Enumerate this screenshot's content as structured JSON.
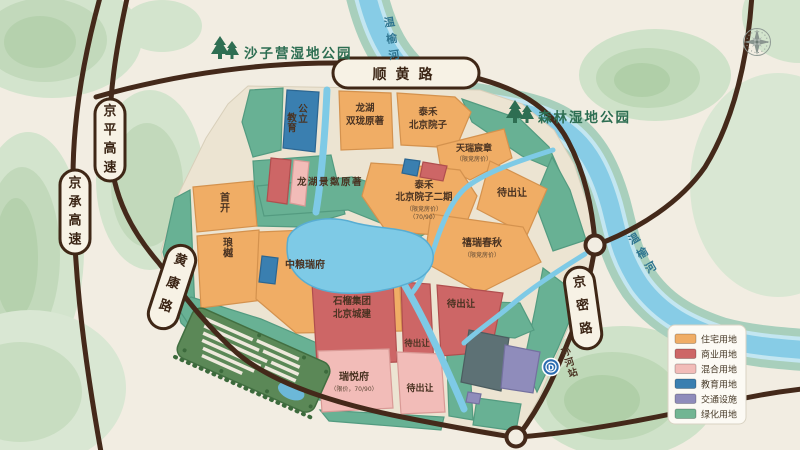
{
  "parks": {
    "shaziying": "沙子营湿地公园",
    "senlin": "森林湿地公园"
  },
  "rivers": {
    "wenyu_north": "温榆河",
    "wenyu_east": "温榆河"
  },
  "roads": {
    "shunhuang": "顺黄路",
    "jingping": "京平高速",
    "jingcheng": "京承高速",
    "huangkang": "黄康路",
    "jingmi": "京密路"
  },
  "station": {
    "name": "孙河站",
    "logo": "D"
  },
  "parcels": {
    "public_education": {
      "col1": "公立",
      "col2": "教育"
    },
    "longhu_shuanglong": {
      "line1": "龙湖",
      "line2": "双珑原著"
    },
    "taihe_yuanzi": {
      "line1": "泰禾",
      "line2": "北京院子"
    },
    "tianrui": {
      "name": "天瑞宸章",
      "note": "（限竞房价）"
    },
    "longhu_jinglin": {
      "name": "龙湖景粼原著"
    },
    "taihe_yuanzi2": {
      "line1": "泰禾",
      "line2": "北京院子二期",
      "note1": "（限竞房价）",
      "note2": "（70/90）"
    },
    "daichurang_ne": {
      "name": "待出让"
    },
    "xirui": {
      "name": "禧瑞春秋",
      "note": "（限竞房价）"
    },
    "shoukai": {
      "name": "首开"
    },
    "langyue": {
      "name": "琅樾"
    },
    "zhongliang": {
      "name": "中粮瑞府"
    },
    "shiliu": {
      "line1": "石榴集团",
      "line2": "北京城建"
    },
    "daichurang_mid": {
      "name": "待出让"
    },
    "daichurang_e": {
      "name": "待出让"
    },
    "ruiyue": {
      "name": "瑞悦府",
      "note": "（限价，70/90）"
    },
    "daichurang_s": {
      "name": "待出让"
    }
  },
  "legend": {
    "items": [
      {
        "label": "住宅用地",
        "color": "#f0ad65"
      },
      {
        "label": "商业用地",
        "color": "#cd6666"
      },
      {
        "label": "混合用地",
        "color": "#f2bcb8"
      },
      {
        "label": "教育用地",
        "color": "#3a7fb0"
      },
      {
        "label": "交通设施",
        "color": "#8f8cbb"
      },
      {
        "label": "绿化用地",
        "color": "#72b593"
      }
    ]
  }
}
